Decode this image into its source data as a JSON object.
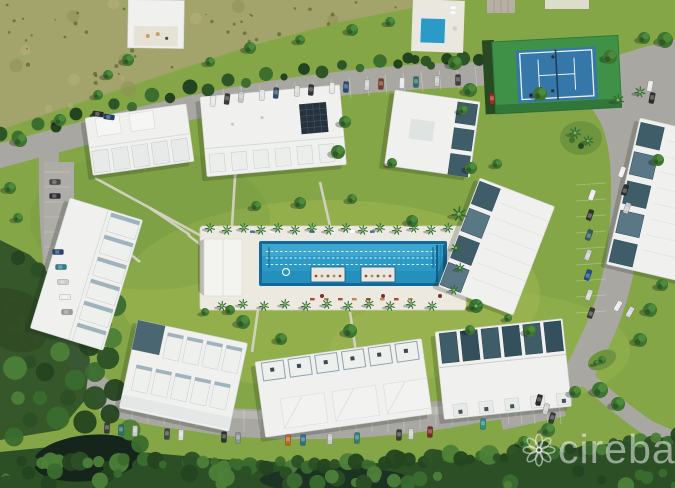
{
  "watermark": {
    "brand": "cireba"
  },
  "palette": {
    "lawn": "#85a647",
    "lawn_light": "#a2ba52",
    "lawn_dark": "#6e9440",
    "road": "#a8a7a2",
    "road_light": "#c2c0b8",
    "roof_white": "#f0f1ef",
    "roof_shade": "#dde1e0",
    "roof_teal": "#3f5d69",
    "roof_teal_light": "#597785",
    "deck": "#ece9e1",
    "pool_rim": "#15689b",
    "pool_water": "#2b9ac6",
    "pool_water_light": "#57b8d8",
    "pool_water_dark": "#1f83ad",
    "solar_panel": "#26323e",
    "tennis_outer": "#3f9148",
    "tennis_inner": "#3577a8",
    "tennis_line": "#eaf2f4",
    "scrub": "#a3a46b",
    "hedge": "#2d5526",
    "tree": "#3e7330",
    "tree_dark": "#27481f",
    "tree_light": "#539441",
    "mangrove": "#2c4f26",
    "pond_brown": "#5d3a26",
    "pond_dark": "#16251b",
    "path": "#d8d5ca",
    "watermark_text": "rgba(255,255,255,0.5)"
  }
}
